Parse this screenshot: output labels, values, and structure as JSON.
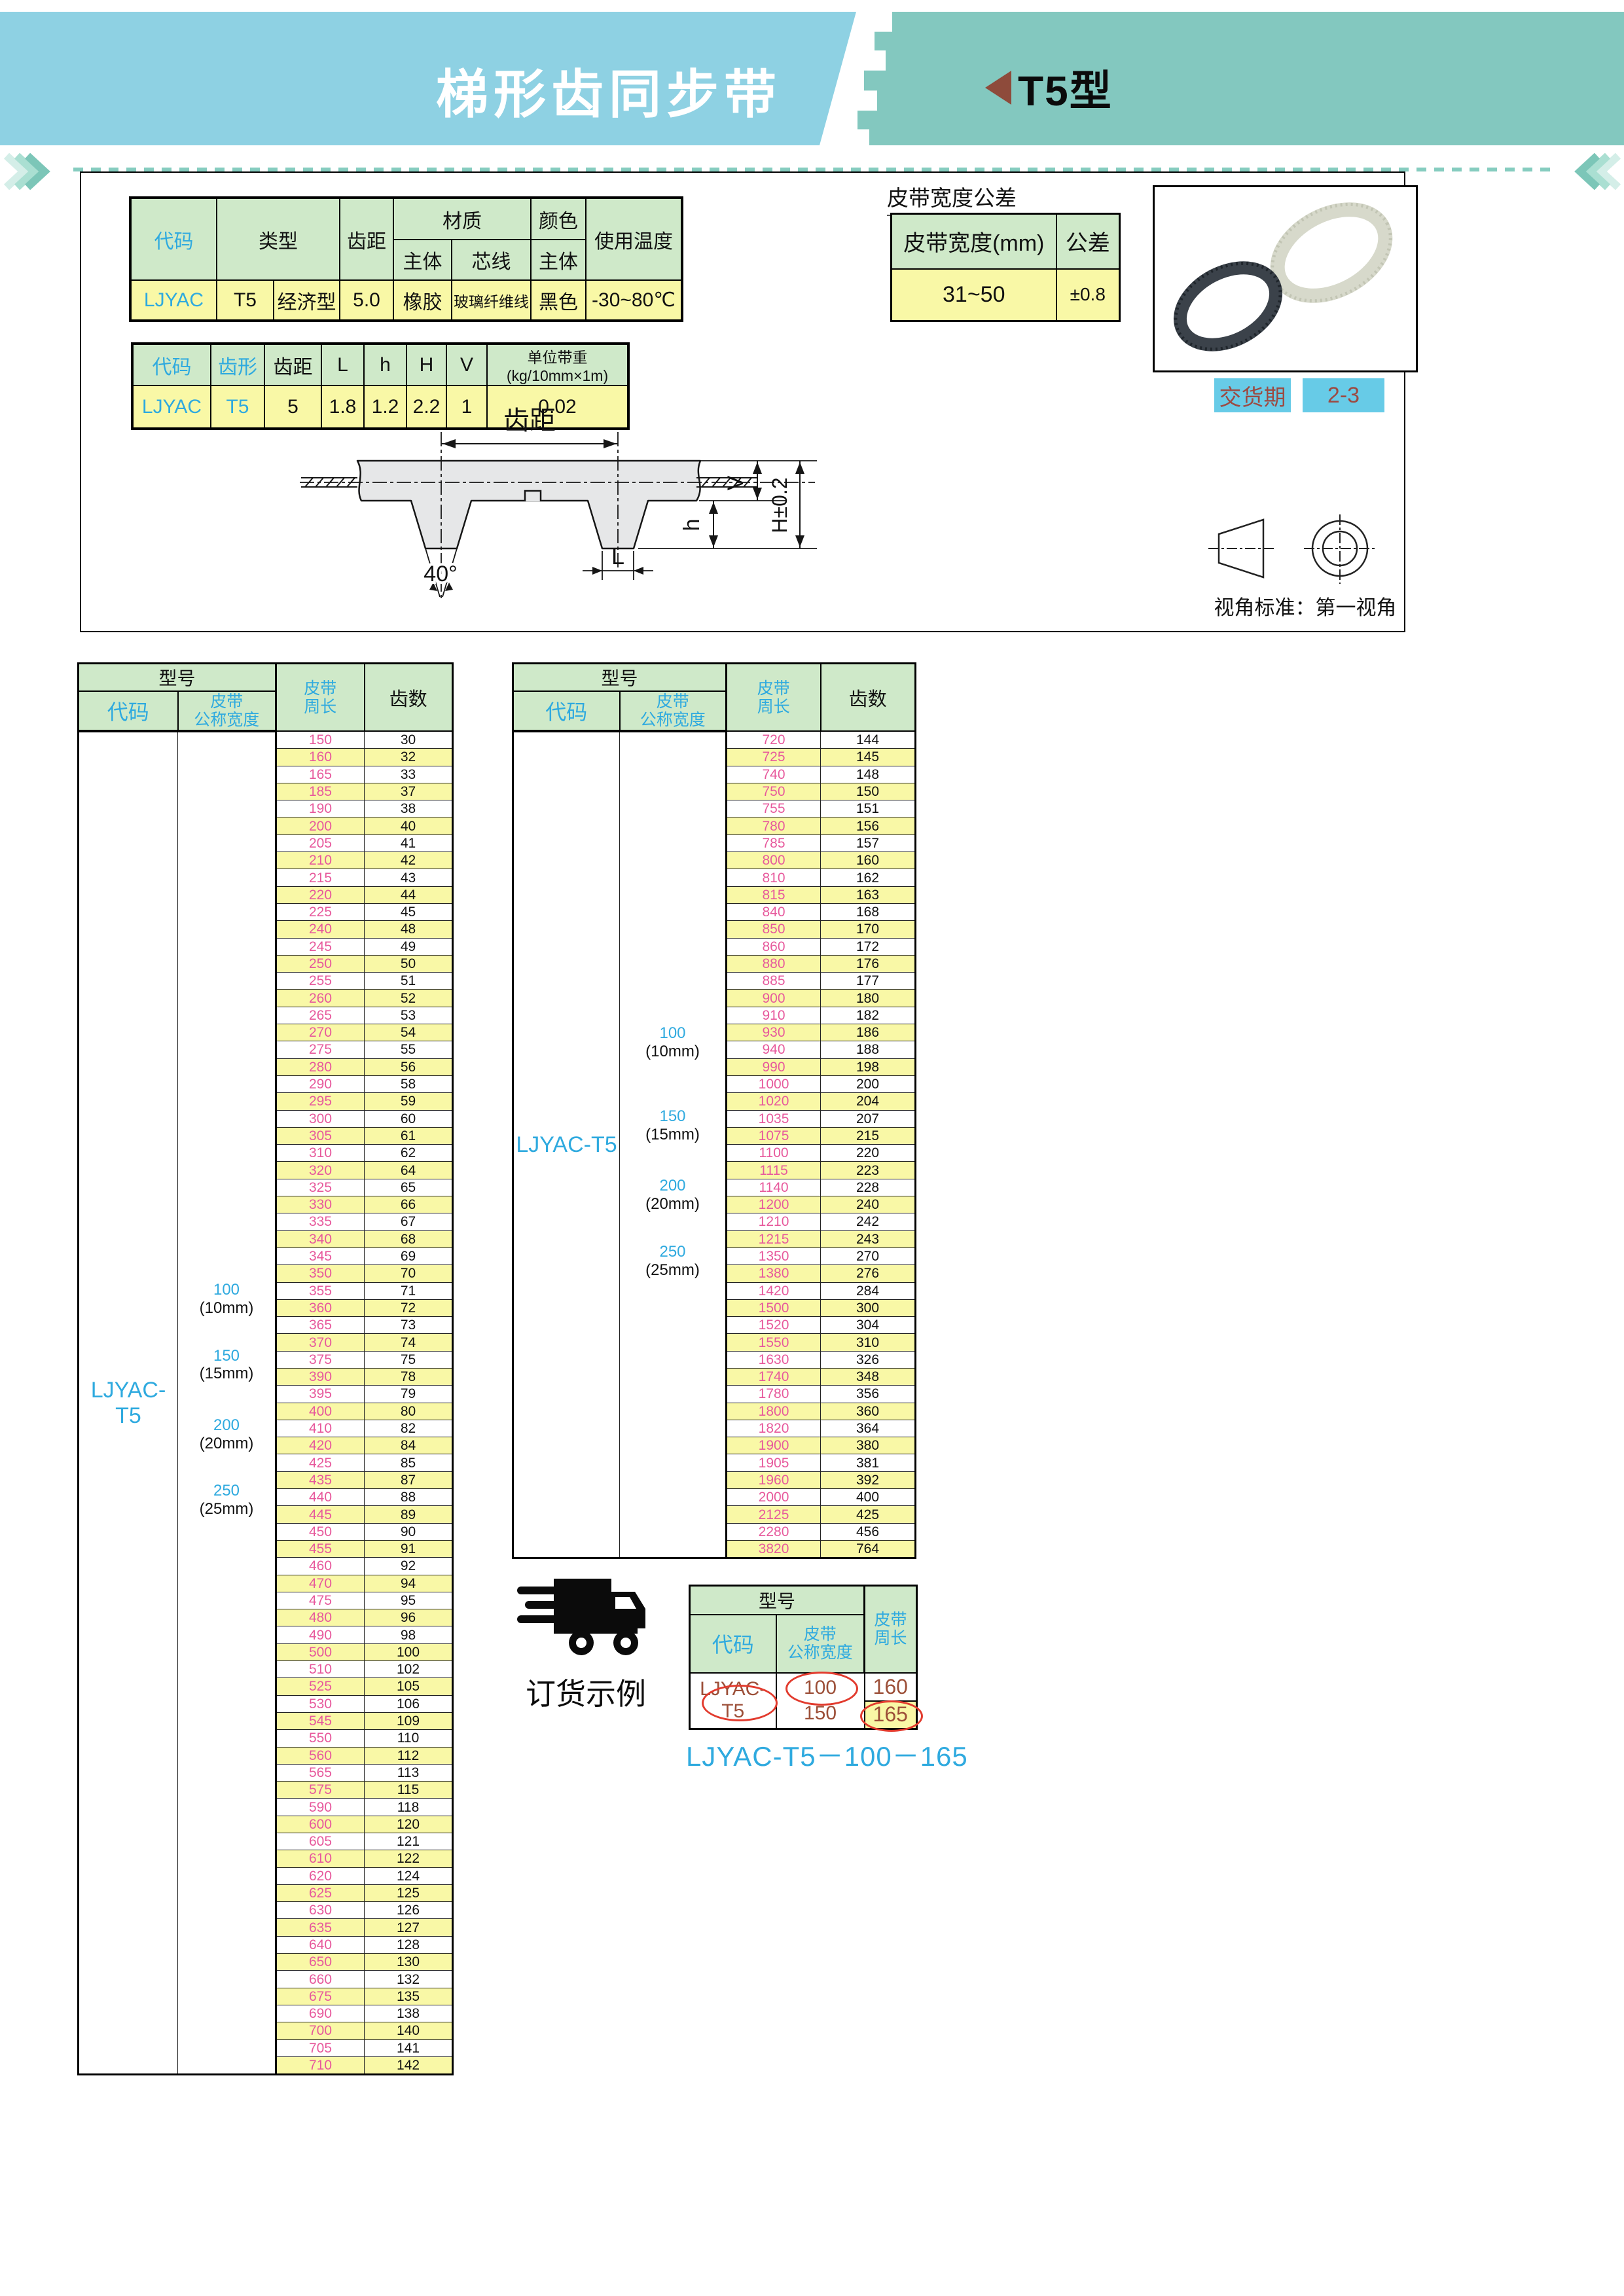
{
  "banner": {
    "title": "梯形齿同步带",
    "tag": "T5型"
  },
  "colors": {
    "banner_blue": "#8ed1e3",
    "banner_teal": "#83c8bf",
    "header_green": "#cfe9c9",
    "row_yellow": "#f9f8a6",
    "length_pink": "#e7599c",
    "accent_cyan": "#2faadf",
    "badge_cyan": "#67cbe7",
    "badge_text": "#9c4a42",
    "order_brown": "#9c4f38",
    "triangle_red": "#8e4b3b"
  },
  "spec1": {
    "h_code": "代码",
    "h_type": "类型",
    "h_pitch": "齿距",
    "h_material": "材质",
    "h_body": "主体",
    "h_cord": "芯线",
    "h_color": "颜色",
    "h_color_body": "主体",
    "h_temp": "使用温度",
    "row": [
      "LJYAC",
      "T5",
      "经济型",
      "5.0",
      "橡胶",
      "玻璃纤维线",
      "黑色",
      "-30~80℃"
    ]
  },
  "spec2": {
    "headers": [
      "代码",
      "齿形",
      "齿距",
      "L",
      "h",
      "H",
      "V",
      "单位带重(kg/10mm×1m)"
    ],
    "row": [
      "LJYAC",
      "T5",
      "5",
      "1.8",
      "1.2",
      "2.2",
      "1",
      "0.02"
    ]
  },
  "tolerance": {
    "title": "皮带宽度公差",
    "col1": "皮带宽度(mm)",
    "col2": "公差",
    "width_range": "31~50",
    "value": "±0.8"
  },
  "delivery": {
    "label": "交货期",
    "value": "2-3"
  },
  "diagram": {
    "pitch_label": "齿距",
    "angle": "40°",
    "dim_v": "V",
    "dim_h_total": "H±0.2",
    "dim_h": "h",
    "dim_l": "L"
  },
  "projection": {
    "note": "视角标准：第一视角"
  },
  "size_tables": {
    "model_header": "型号",
    "code_header": "代码",
    "width_header": "皮带\n公称宽度",
    "length_header": "皮带\n周长",
    "teeth_header": "齿数",
    "code_value": "LJYAC-T5",
    "width_labels": [
      {
        "width": "100",
        "note": "(10mm)"
      },
      {
        "width": "150",
        "note": "(15mm)"
      },
      {
        "width": "200",
        "note": "(20mm)"
      },
      {
        "width": "250",
        "note": "(25mm)"
      }
    ],
    "left_rows": [
      [
        150,
        30
      ],
      [
        160,
        32
      ],
      [
        165,
        33
      ],
      [
        185,
        37
      ],
      [
        190,
        38
      ],
      [
        200,
        40
      ],
      [
        205,
        41
      ],
      [
        210,
        42
      ],
      [
        215,
        43
      ],
      [
        220,
        44
      ],
      [
        225,
        45
      ],
      [
        240,
        48
      ],
      [
        245,
        49
      ],
      [
        250,
        50
      ],
      [
        255,
        51
      ],
      [
        260,
        52
      ],
      [
        265,
        53
      ],
      [
        270,
        54
      ],
      [
        275,
        55
      ],
      [
        280,
        56
      ],
      [
        290,
        58
      ],
      [
        295,
        59
      ],
      [
        300,
        60
      ],
      [
        305,
        61
      ],
      [
        310,
        62
      ],
      [
        320,
        64
      ],
      [
        325,
        65
      ],
      [
        330,
        66
      ],
      [
        335,
        67
      ],
      [
        340,
        68
      ],
      [
        345,
        69
      ],
      [
        350,
        70
      ],
      [
        355,
        71
      ],
      [
        360,
        72
      ],
      [
        365,
        73
      ],
      [
        370,
        74
      ],
      [
        375,
        75
      ],
      [
        390,
        78
      ],
      [
        395,
        79
      ],
      [
        400,
        80
      ],
      [
        410,
        82
      ],
      [
        420,
        84
      ],
      [
        425,
        85
      ],
      [
        435,
        87
      ],
      [
        440,
        88
      ],
      [
        445,
        89
      ],
      [
        450,
        90
      ],
      [
        455,
        91
      ],
      [
        460,
        92
      ],
      [
        470,
        94
      ],
      [
        475,
        95
      ],
      [
        480,
        96
      ],
      [
        490,
        98
      ],
      [
        500,
        100
      ],
      [
        510,
        102
      ],
      [
        525,
        105
      ],
      [
        530,
        106
      ],
      [
        545,
        109
      ],
      [
        550,
        110
      ],
      [
        560,
        112
      ],
      [
        565,
        113
      ],
      [
        575,
        115
      ],
      [
        590,
        118
      ],
      [
        600,
        120
      ],
      [
        605,
        121
      ],
      [
        610,
        122
      ],
      [
        620,
        124
      ],
      [
        625,
        125
      ],
      [
        630,
        126
      ],
      [
        635,
        127
      ],
      [
        640,
        128
      ],
      [
        650,
        130
      ],
      [
        660,
        132
      ],
      [
        675,
        135
      ],
      [
        690,
        138
      ],
      [
        700,
        140
      ],
      [
        705,
        141
      ],
      [
        710,
        142
      ]
    ],
    "right_rows": [
      [
        720,
        144
      ],
      [
        725,
        145
      ],
      [
        740,
        148
      ],
      [
        750,
        150
      ],
      [
        755,
        151
      ],
      [
        780,
        156
      ],
      [
        785,
        157
      ],
      [
        800,
        160
      ],
      [
        810,
        162
      ],
      [
        815,
        163
      ],
      [
        840,
        168
      ],
      [
        850,
        170
      ],
      [
        860,
        172
      ],
      [
        880,
        176
      ],
      [
        885,
        177
      ],
      [
        900,
        180
      ],
      [
        910,
        182
      ],
      [
        930,
        186
      ],
      [
        940,
        188
      ],
      [
        990,
        198
      ],
      [
        1000,
        200
      ],
      [
        1020,
        204
      ],
      [
        1035,
        207
      ],
      [
        1075,
        215
      ],
      [
        1100,
        220
      ],
      [
        1115,
        223
      ],
      [
        1140,
        228
      ],
      [
        1200,
        240
      ],
      [
        1210,
        242
      ],
      [
        1215,
        243
      ],
      [
        1350,
        270
      ],
      [
        1380,
        276
      ],
      [
        1420,
        284
      ],
      [
        1500,
        300
      ],
      [
        1520,
        304
      ],
      [
        1550,
        310
      ],
      [
        1630,
        326
      ],
      [
        1740,
        348
      ],
      [
        1780,
        356
      ],
      [
        1800,
        360
      ],
      [
        1820,
        364
      ],
      [
        1900,
        380
      ],
      [
        1905,
        381
      ],
      [
        1960,
        392
      ],
      [
        2000,
        400
      ],
      [
        2125,
        425
      ],
      [
        2280,
        456
      ],
      [
        3820,
        764
      ]
    ]
  },
  "order": {
    "title": "订货示例",
    "code": "LJYAC-T5",
    "width1": "100",
    "width2": "150",
    "len1": "160",
    "len2": "165",
    "model_string": "LJYAC-T5－100－165"
  }
}
